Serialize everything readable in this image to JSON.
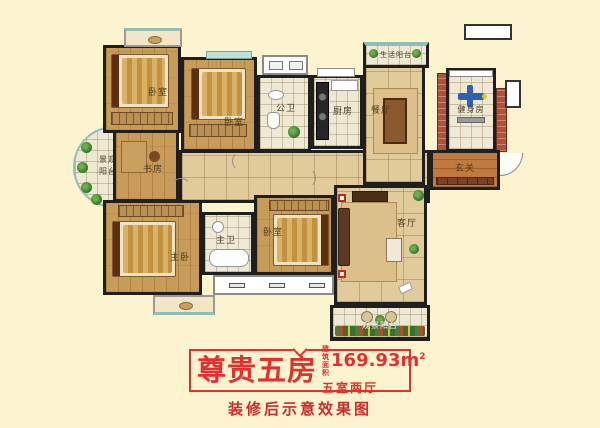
{
  "colors": {
    "page_background": "#FBF4CF",
    "accent_red": "#E3302E",
    "caption_red": "#CB2B2B",
    "wall_black": "#1F1F1F",
    "wood_floor": "#C99B58",
    "tile_floor": "#EFE8D2",
    "brick_wall": "#B14F38"
  },
  "floorplan": {
    "rooms": [
      {
        "id": "bedroom-1",
        "label": "卧室"
      },
      {
        "id": "bedroom-2",
        "label": "卧室"
      },
      {
        "id": "public-bath",
        "label": "公卫"
      },
      {
        "id": "kitchen",
        "label": "厨房"
      },
      {
        "id": "dining-room",
        "label": "餐厅"
      },
      {
        "id": "service-balcony",
        "label": "生活阳台"
      },
      {
        "id": "gym",
        "label": "健身房"
      },
      {
        "id": "foyer",
        "label": "玄关"
      },
      {
        "id": "study",
        "label": "书房"
      },
      {
        "id": "landscape-balcony",
        "label": "景观阳台"
      },
      {
        "id": "master-bedroom",
        "label": "主卧"
      },
      {
        "id": "master-bath",
        "label": "主卫"
      },
      {
        "id": "bedroom-3",
        "label": "卧室"
      },
      {
        "id": "living-room",
        "label": "客厅"
      },
      {
        "id": "view-balcony",
        "label": "观景阳台"
      }
    ]
  },
  "banner": {
    "title": "尊贵五房",
    "area_label_l1": "建筑",
    "area_label_l2": "面积",
    "area_value": "169.93m",
    "area_sup": "2",
    "layout": "五室两厅"
  },
  "caption": {
    "text": "装修后示意效果图"
  }
}
